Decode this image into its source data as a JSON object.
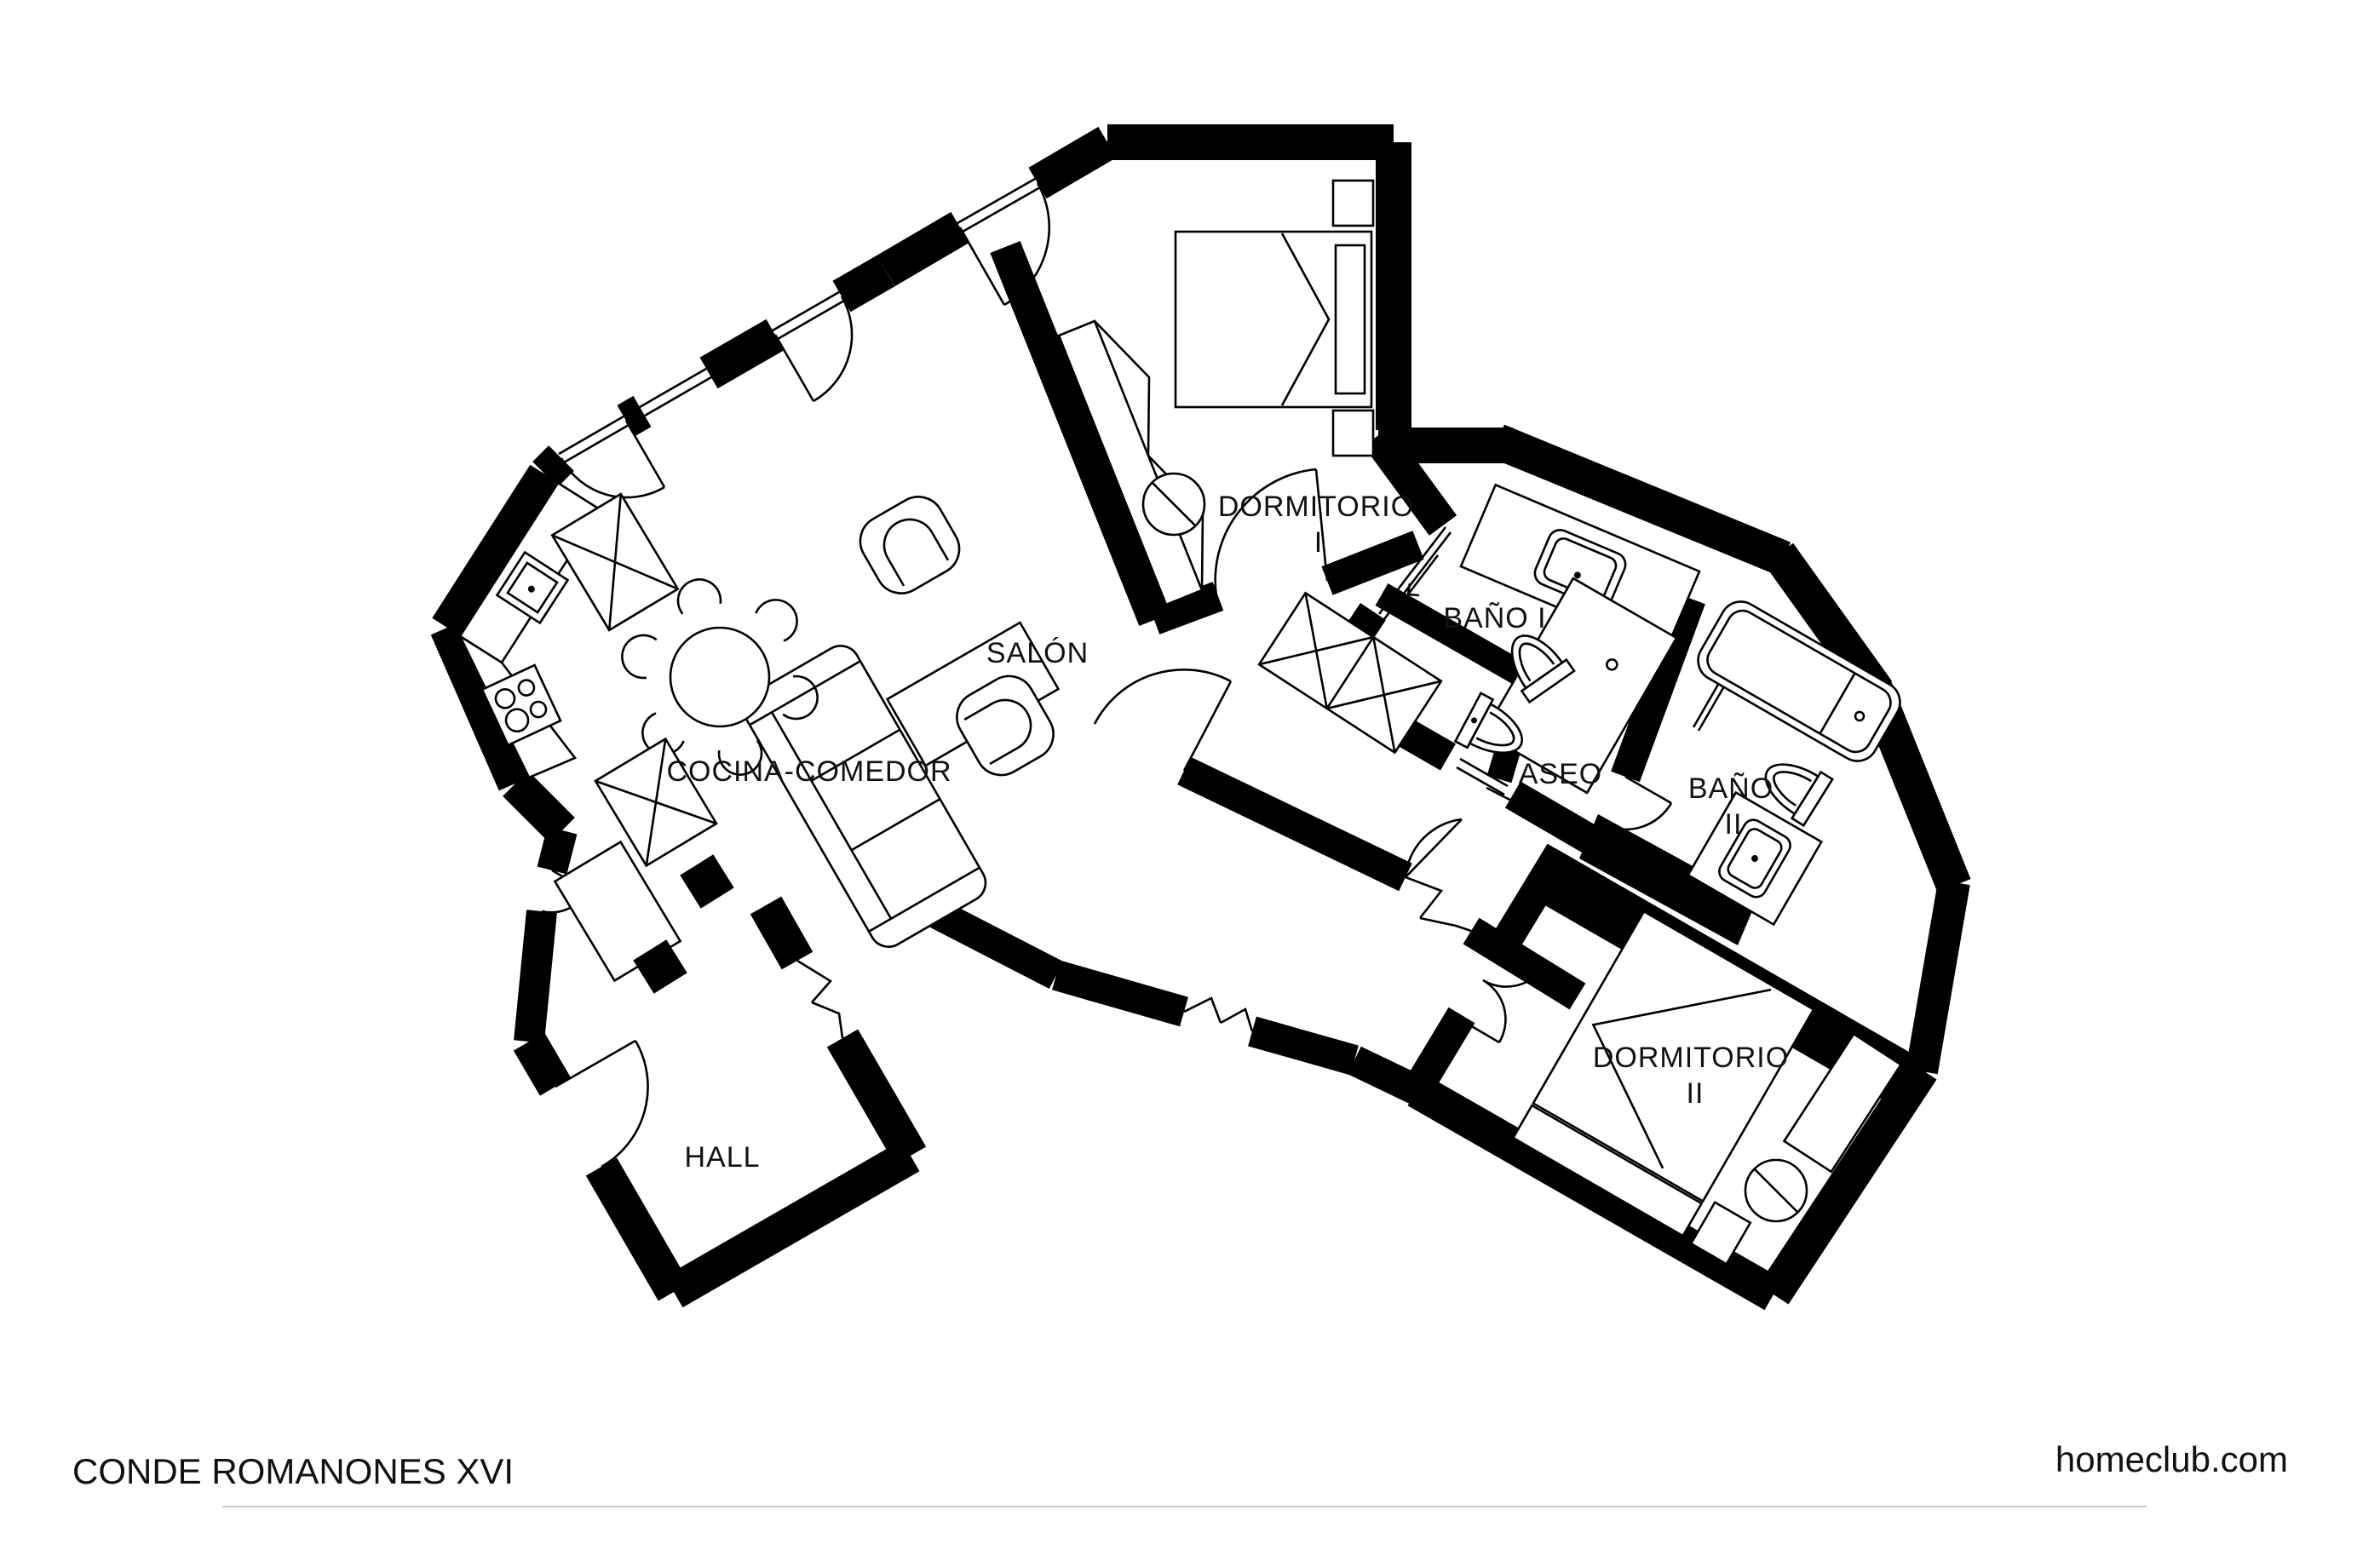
{
  "document": {
    "type": "architectural-floor-plan",
    "paper_color": "#ffffff",
    "ink_color": "#000000",
    "rule_color": "#c9c9c9"
  },
  "footer": {
    "project_title": "CONDE ROMANONES XVI",
    "brand": "homeclub.com"
  },
  "rooms": {
    "salon": {
      "label": "SALÓN"
    },
    "cocina": {
      "label": "COCINA-COMEDOR"
    },
    "hall": {
      "label": "HALL"
    },
    "dormitorio1": {
      "label": "DORMITORIO",
      "label_line2": "I"
    },
    "bano1": {
      "label": "BAÑO I"
    },
    "aseo": {
      "label": "ASEO"
    },
    "bano2": {
      "label": "BAÑO",
      "label_line2": "II"
    },
    "dormitorio2": {
      "label": "DORMITORIO",
      "label_line2": "II"
    }
  }
}
